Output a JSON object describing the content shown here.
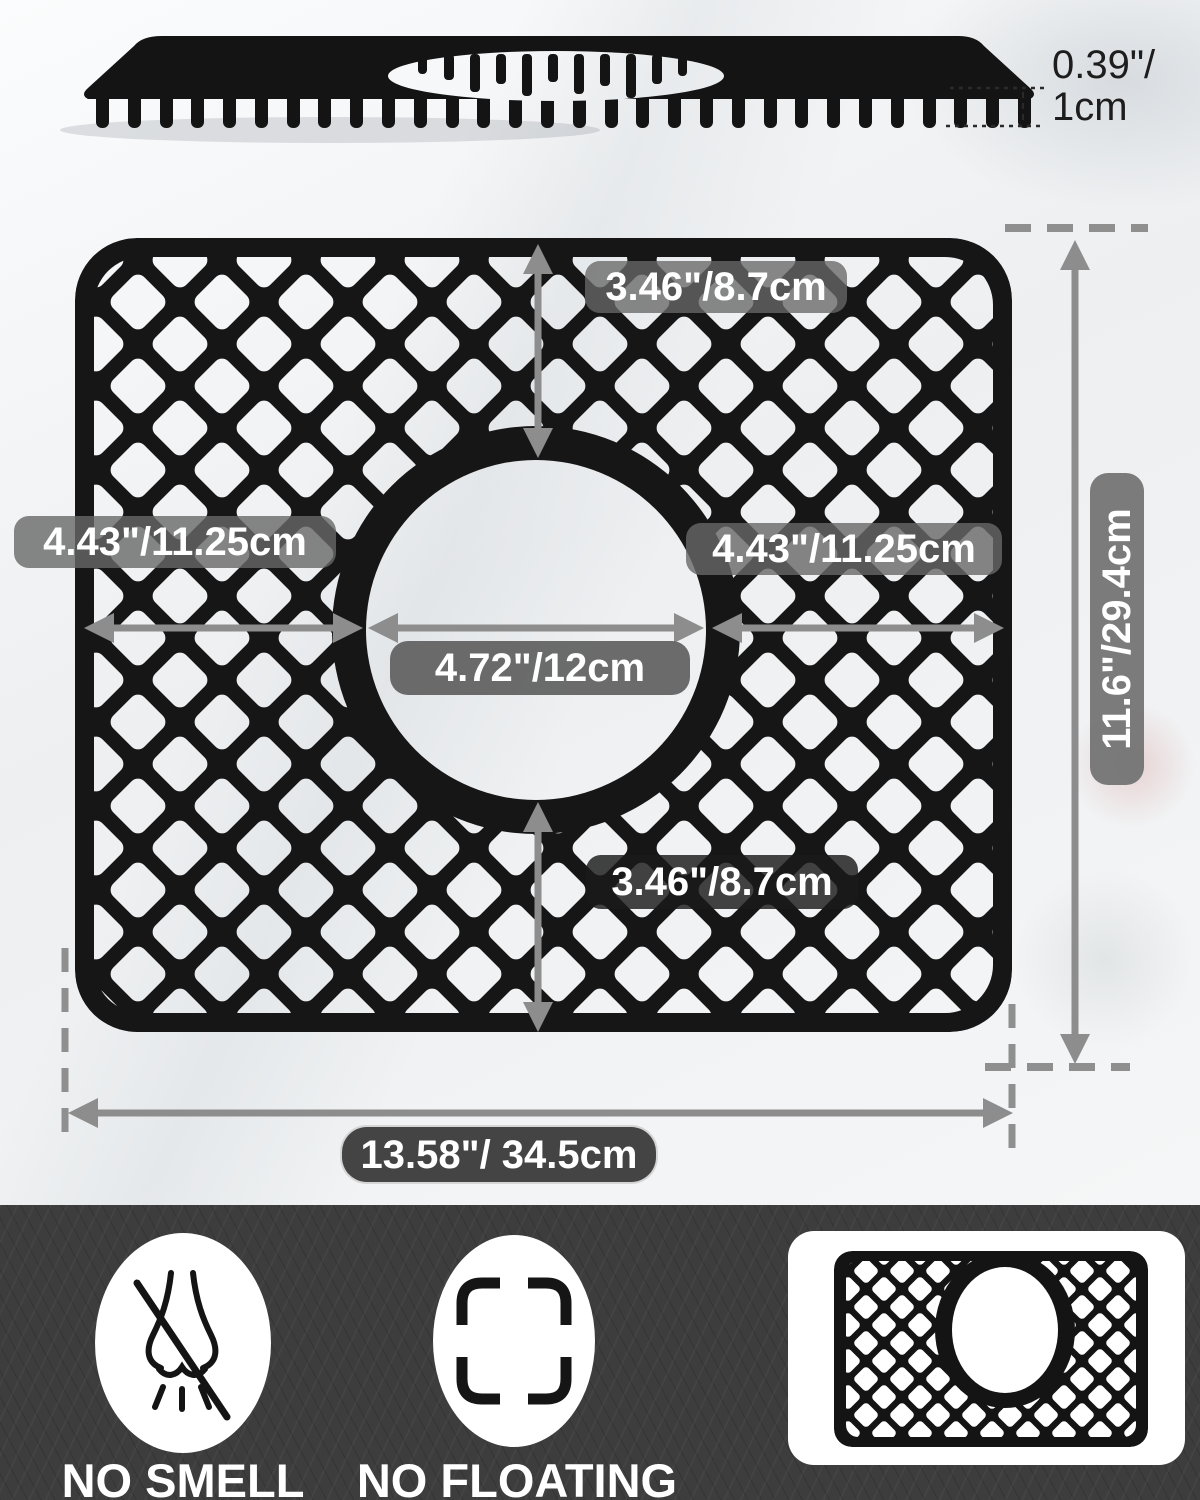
{
  "side_view": {
    "thickness_in": "0.39\"/",
    "thickness_cm": "1cm"
  },
  "main_diagram": {
    "top_to_hole": "3.46\"/8.7cm",
    "left_to_hole": "4.43\"/11.25cm",
    "hole_to_right": "4.43\"/11.25cm",
    "hole_diameter": "4.72\"/12cm",
    "hole_to_bottom": "3.46\"/8.7cm",
    "overall_height": "11.6\"/29.4cm",
    "overall_width": "13.58\"/ 34.5cm"
  },
  "features": [
    {
      "label": "NO SMELL",
      "icon": "no-smell-icon"
    },
    {
      "label": "NO FLOATING",
      "icon": "no-floating-icon"
    },
    {
      "label": "",
      "icon": "sink-mat-thumbnail"
    }
  ],
  "colors": {
    "mat": "#161616",
    "dimension_gray": "#8d8d8d",
    "band_background": "#3d3d3d",
    "label_text": "#ffffff"
  }
}
